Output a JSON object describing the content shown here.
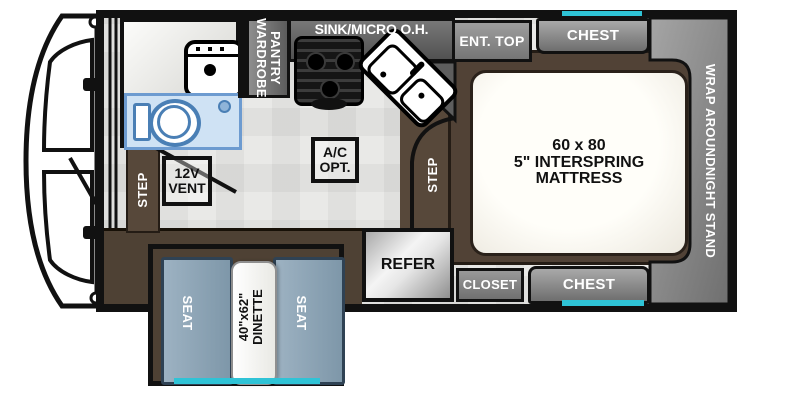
{
  "plan": {
    "type": "truck-camper floor plan",
    "colors": {
      "wall": "#111111",
      "floor": "#e9e9e7",
      "floor_brown": "#4e4134",
      "step_brown": "#57483a",
      "cabinet_gray": "#8e8e8e",
      "seat_blue": "#8ba2b4",
      "tub_blue": "#cfe2f4",
      "tub_outline": "#6d9bd0",
      "window_teal": "#2fc3d6",
      "refer_silver": "#e6e6e6",
      "mattress": "#fffef9"
    },
    "labels": {
      "overhead": "SINK/MICRO O.H.",
      "ent_top": "ENT. TOP",
      "chest_top": "CHEST",
      "chest_bottom": "CHEST",
      "closet": "CLOSET",
      "refer": "REFER",
      "wardrobe_word1": "WARDROBE",
      "wardrobe_word2": "PANTRY",
      "nightstand": "WRAP AROUNDNIGHT STAND",
      "mattress_line1": "60 x 80",
      "mattress_line2": "5\" INTERSPRING",
      "mattress_line3": "MATTRESS",
      "ac_line1": "A/C",
      "ac_line2": "OPT.",
      "vent_line1": "12V",
      "vent_line2": "VENT",
      "step_left": "STEP",
      "step_center": "STEP",
      "seat_left": "SEAT",
      "seat_right": "SEAT",
      "dinette_line1": "40\"x62\"",
      "dinette_line2": "DINETTE"
    }
  }
}
